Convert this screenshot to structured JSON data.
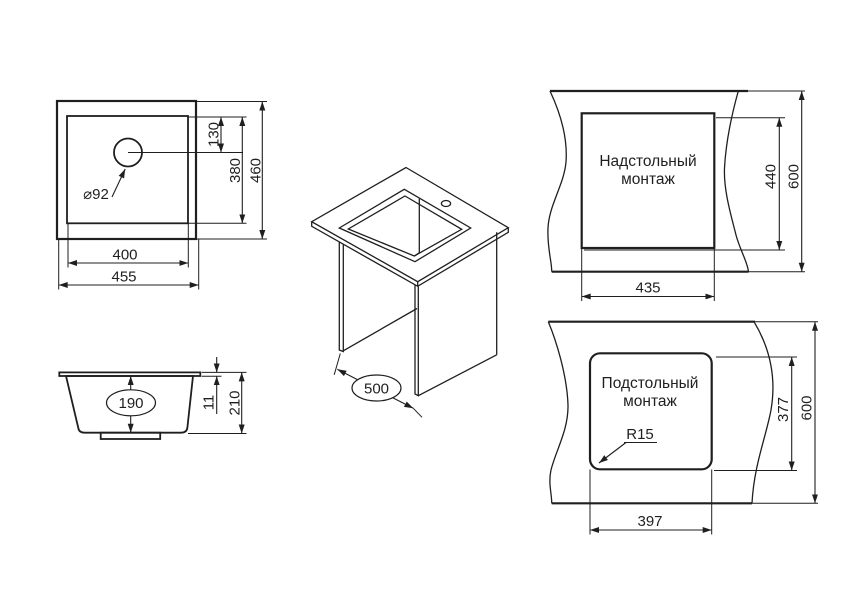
{
  "drawing": {
    "top_view": {
      "dim_hole_offset": "130",
      "dim_inner_height": "380",
      "dim_outer_height": "460",
      "dim_inner_width": "400",
      "dim_outer_width": "455",
      "hole_diameter": "⌀92"
    },
    "section_view": {
      "dim_bowl_depth": "190",
      "dim_rim_thickness": "11",
      "dim_total_height": "210"
    },
    "iso_view": {
      "dim_depth": "500"
    },
    "overmount_view": {
      "title_line1": "Надстольный",
      "title_line2": "монтаж",
      "dim_cutout_width": "435",
      "dim_cutout_height": "440",
      "dim_counter_depth": "600"
    },
    "undermount_view": {
      "title_line1": "Подстольный",
      "title_line2": "монтаж",
      "dim_cutout_width": "397",
      "dim_cutout_height": "377",
      "dim_counter_depth": "600",
      "dim_corner_radius": "R15"
    }
  },
  "colors": {
    "line": "#1f1f1f",
    "background": "#ffffff"
  }
}
